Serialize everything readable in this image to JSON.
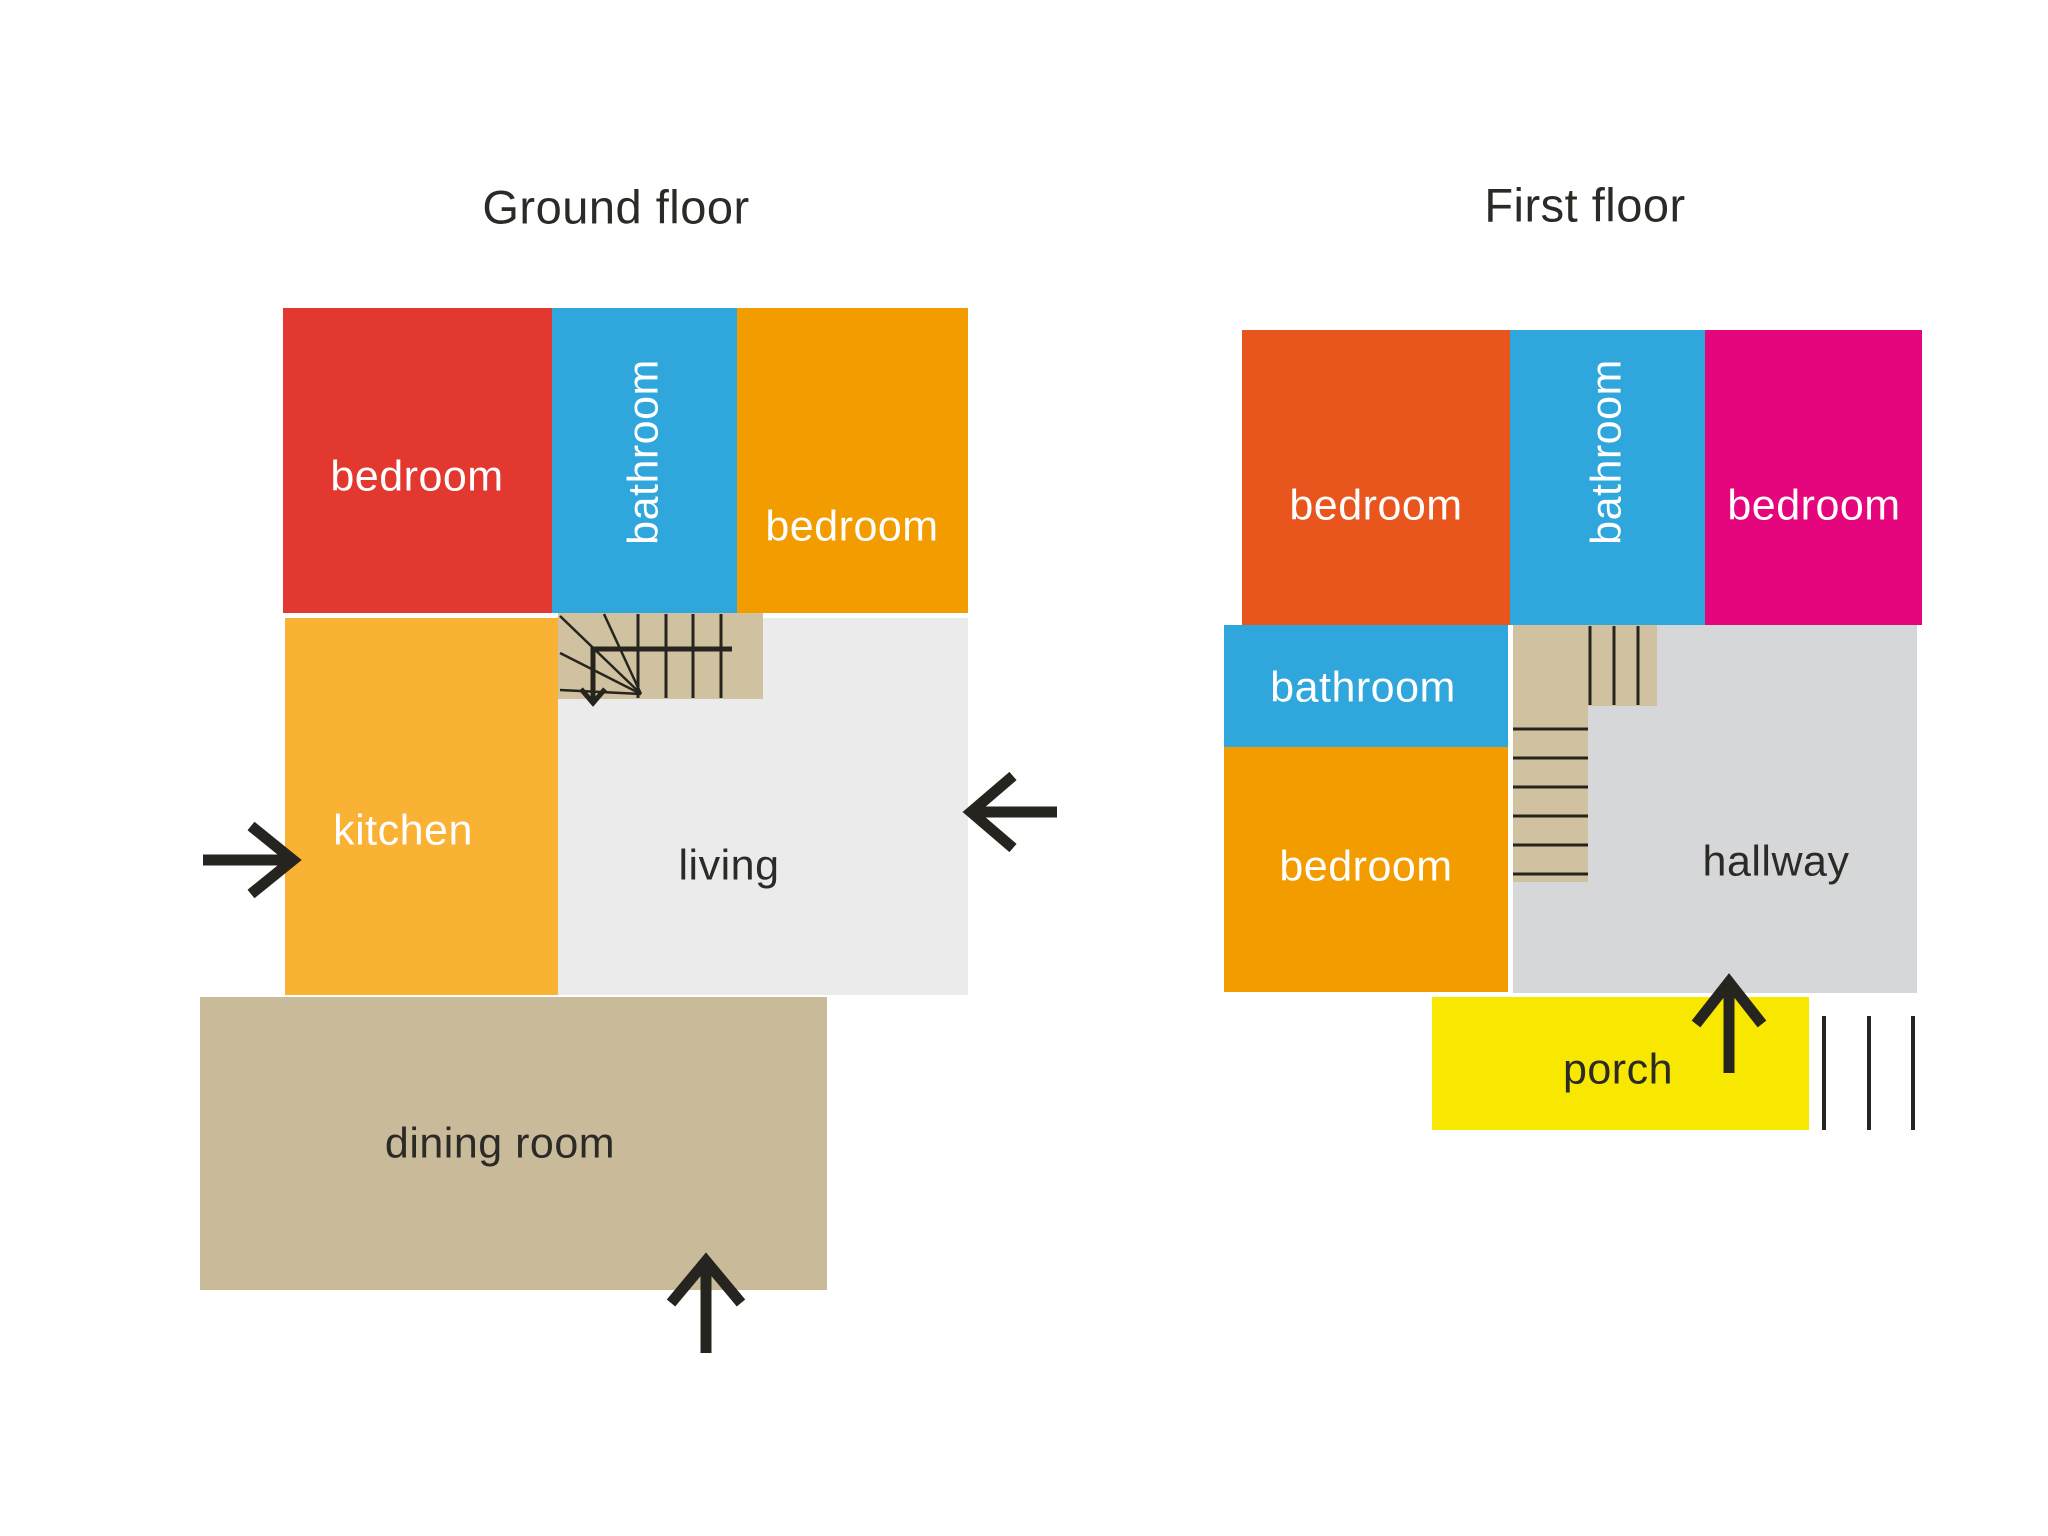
{
  "colors": {
    "background": "#ffffff",
    "ink": "#26241f",
    "red_bedroom": "#e2382f",
    "blue_bathroom": "#2fa7dc",
    "orange_bedroom": "#f39c00",
    "kitchen_orange": "#f9b234",
    "living_gray": "#ebebec",
    "tan_stairs": "#d0c2a0",
    "tan_dining": "#c9bb9a",
    "orange_red_bedroom": "#e8561e",
    "magenta_bedroom": "#e5067e",
    "hallway_gray": "#d6d7d8",
    "porch_yellow": "#f8e800",
    "label_light": "#ffffff",
    "label_dark": "#2b2a26"
  },
  "ground_floor": {
    "title": "Ground floor",
    "rooms": {
      "bedroom_left": {
        "label": "bedroom"
      },
      "bathroom": {
        "label": "bathroom"
      },
      "bedroom_right": {
        "label": "bedroom"
      },
      "kitchen": {
        "label": "kitchen"
      },
      "living": {
        "label": "living"
      },
      "dining": {
        "label": "dining room"
      }
    }
  },
  "first_floor": {
    "title": "First floor",
    "rooms": {
      "bedroom_left": {
        "label": "bedroom"
      },
      "bathroom_top": {
        "label": "bathroom"
      },
      "bedroom_right": {
        "label": "bedroom"
      },
      "bathroom_small": {
        "label": "bathroom"
      },
      "bedroom_bottom": {
        "label": "bedroom"
      },
      "hallway": {
        "label": "hallway"
      },
      "porch": {
        "label": "porch"
      }
    }
  }
}
